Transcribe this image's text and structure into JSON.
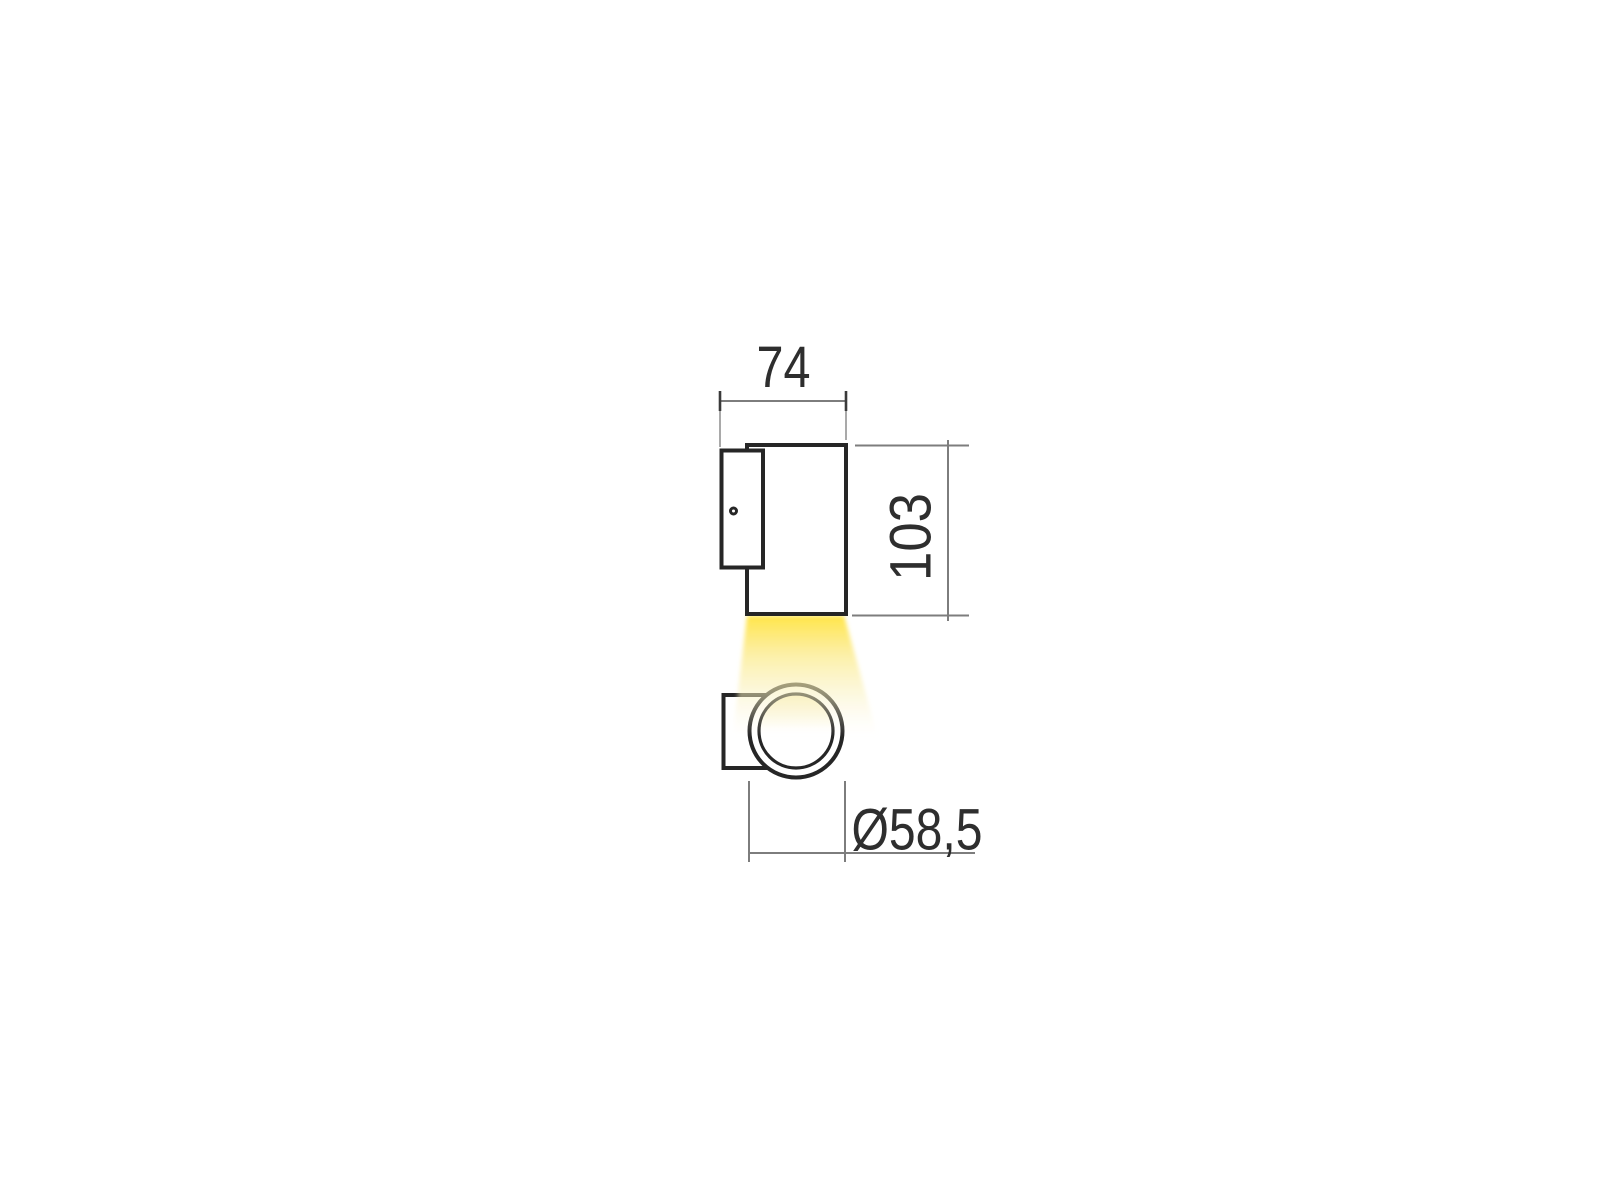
{
  "diagram": {
    "kind": "technical-dimension-drawing",
    "subject": "cylindrical wall-mounted spotlight with downward light beam",
    "views": [
      "side-profile",
      "front-face"
    ],
    "dimensions": {
      "width": {
        "label": "74",
        "orientation": "horizontal-top"
      },
      "height": {
        "label": "103",
        "orientation": "vertical-right-rotated"
      },
      "diameter": {
        "label": "Ø58,5",
        "orientation": "horizontal-bottom"
      }
    },
    "colors": {
      "background": "#ffffff",
      "outline": "#262626",
      "dimension_line": "#7d7d7d",
      "extension_line": "#9a9a9a",
      "dimension_tick": "#3a3a3a",
      "text": "#2e2e2e",
      "beam_yellow_strong": "#ffe441",
      "beam_yellow_mid": "#fcec92",
      "beam_yellow_faint": "#fbf5d6",
      "glow_tint": "#faf1c4"
    }
  }
}
